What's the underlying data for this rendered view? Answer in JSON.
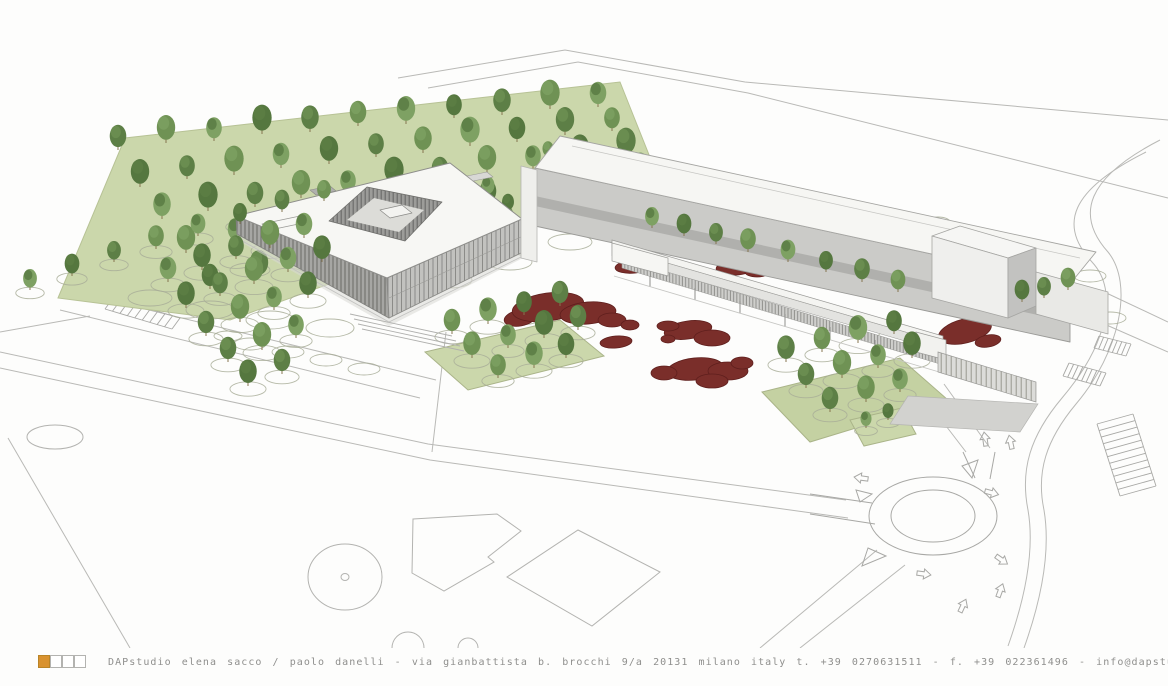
{
  "footer": {
    "studio": "DAPstudio",
    "partners": "elena sacco / paolo danelli",
    "address": "via gianbattista b. brocchi 9/a 20131 milano italy",
    "phone": "t. +39 0270631511",
    "fax": "f. +39 022361496",
    "email": "info@dapstudio.com",
    "website": "www.dapstudio.com",
    "text": "DAPstudio elena sacco / paolo danelli - via gianbattista b. brocchi 9/a 20131 milano italy  t. +39 0270631511 - f. +39 022361496 - info@dapstudio.com - www.dapstudio.com",
    "logo_squares": 4,
    "accent_color": "#d9922f"
  },
  "colors": {
    "accent": "#d9922f",
    "line": "#b6b6b3",
    "line_soft": "#c6c6c3",
    "lawn": "#cbd7ab",
    "lawn_stroke": "#a3ab84",
    "red_bed": "#7a2e2a",
    "red_bed_stroke": "#5f1f1d",
    "roof_white": "#f7f7f4",
    "facade_gray": "#c9c9c6",
    "trunk": "#86754f",
    "circle_outline": "#a8ad98"
  },
  "scene": {
    "description": "aerial rendering of courtyard building, linear building with canopy walkway, tree grove, plaza with red planting beds, parking and roundabout",
    "tree_palette": [
      "#5d7f46",
      "#6f9254",
      "#7ea163",
      "#55773f"
    ],
    "tree_groups": [
      {
        "name": "grove-back",
        "layer": "back",
        "circles": false,
        "trees": [
          [
            118,
            150,
            18
          ],
          [
            166,
            143,
            20
          ],
          [
            214,
            141,
            17
          ],
          [
            262,
            134,
            21
          ],
          [
            310,
            132,
            19
          ],
          [
            358,
            126,
            18
          ],
          [
            406,
            124,
            20
          ],
          [
            454,
            118,
            17
          ],
          [
            502,
            115,
            19
          ],
          [
            550,
            109,
            21
          ],
          [
            598,
            107,
            18
          ],
          [
            140,
            187,
            20
          ],
          [
            187,
            179,
            17
          ],
          [
            234,
            175,
            21
          ],
          [
            281,
            168,
            18
          ],
          [
            329,
            164,
            20
          ],
          [
            376,
            157,
            17
          ],
          [
            423,
            153,
            19
          ],
          [
            470,
            146,
            21
          ],
          [
            517,
            142,
            18
          ],
          [
            565,
            135,
            20
          ],
          [
            612,
            131,
            17
          ],
          [
            162,
            219,
            19
          ],
          [
            208,
            211,
            21
          ],
          [
            255,
            207,
            18
          ],
          [
            301,
            198,
            20
          ],
          [
            348,
            194,
            17
          ],
          [
            394,
            186,
            21
          ],
          [
            440,
            182,
            18
          ],
          [
            487,
            173,
            20
          ],
          [
            533,
            169,
            17
          ],
          [
            580,
            161,
            19
          ],
          [
            626,
            157,
            21
          ],
          [
            186,
            253,
            20
          ],
          [
            236,
            243,
            18
          ],
          [
            287,
            237,
            21
          ],
          [
            337,
            227,
            17
          ],
          [
            388,
            221,
            19
          ],
          [
            438,
            211,
            21
          ],
          [
            488,
            205,
            18
          ],
          [
            539,
            195,
            20
          ],
          [
            589,
            189,
            17
          ],
          [
            640,
            179,
            19
          ],
          [
            210,
            289,
            18
          ],
          [
            259,
            278,
            20
          ],
          [
            308,
            271,
            17
          ],
          [
            357,
            261,
            19
          ],
          [
            406,
            250,
            21
          ],
          [
            455,
            243,
            18
          ],
          [
            504,
            231,
            20
          ],
          [
            553,
            224,
            17
          ],
          [
            602,
            213,
            19
          ],
          [
            652,
            206,
            21
          ]
        ]
      },
      {
        "name": "gap-trees",
        "layer": "back",
        "circles": false,
        "trees": [
          [
            468,
            206,
            13
          ],
          [
            488,
            196,
            14
          ],
          [
            508,
            212,
            13
          ],
          [
            478,
            222,
            12
          ],
          [
            548,
            158,
            12
          ]
        ]
      },
      {
        "name": "facade-row",
        "layer": "mid",
        "circles": true,
        "trees": [
          [
            652,
            228,
            15
          ],
          [
            684,
            236,
            16
          ],
          [
            716,
            244,
            15
          ],
          [
            748,
            252,
            17
          ],
          [
            788,
            262,
            16
          ],
          [
            826,
            272,
            15
          ],
          [
            862,
            282,
            17
          ],
          [
            898,
            292,
            16
          ]
        ]
      },
      {
        "name": "row-left",
        "layer": "front",
        "circles": true,
        "trees": [
          [
            30,
            290,
            15
          ],
          [
            72,
            276,
            16
          ],
          [
            114,
            262,
            15
          ],
          [
            156,
            249,
            17
          ],
          [
            198,
            236,
            16
          ],
          [
            240,
            224,
            15
          ],
          [
            282,
            212,
            16
          ],
          [
            324,
            201,
            15
          ]
        ]
      },
      {
        "name": "cluster-front-left",
        "layer": "front",
        "circles": true,
        "trees": [
          [
            168,
            282,
            18
          ],
          [
            202,
            270,
            19
          ],
          [
            236,
            259,
            17
          ],
          [
            270,
            248,
            20
          ],
          [
            304,
            238,
            18
          ],
          [
            186,
            308,
            19
          ],
          [
            220,
            296,
            17
          ],
          [
            254,
            284,
            20
          ],
          [
            288,
            272,
            18
          ],
          [
            322,
            262,
            19
          ],
          [
            206,
            336,
            18
          ],
          [
            240,
            322,
            20
          ],
          [
            274,
            310,
            17
          ],
          [
            308,
            298,
            19
          ],
          [
            228,
            362,
            18
          ],
          [
            262,
            350,
            20
          ],
          [
            296,
            338,
            17
          ],
          [
            248,
            386,
            19
          ],
          [
            282,
            374,
            18
          ]
        ]
      },
      {
        "name": "plaza-left-cluster",
        "layer": "front",
        "circles": true,
        "trees": [
          [
            452,
            334,
            18
          ],
          [
            488,
            324,
            19
          ],
          [
            524,
            315,
            17
          ],
          [
            560,
            306,
            18
          ],
          [
            472,
            358,
            19
          ],
          [
            508,
            348,
            17
          ],
          [
            544,
            338,
            20
          ],
          [
            578,
            330,
            18
          ],
          [
            498,
            378,
            17
          ],
          [
            534,
            368,
            19
          ],
          [
            566,
            358,
            18
          ]
        ]
      },
      {
        "name": "plaza-right-cluster",
        "layer": "front",
        "circles": true,
        "trees": [
          [
            786,
            362,
            19
          ],
          [
            822,
            352,
            18
          ],
          [
            858,
            343,
            20
          ],
          [
            894,
            334,
            17
          ],
          [
            806,
            388,
            18
          ],
          [
            842,
            378,
            20
          ],
          [
            878,
            368,
            17
          ],
          [
            912,
            358,
            19
          ],
          [
            830,
            412,
            18
          ],
          [
            866,
            402,
            19
          ],
          [
            900,
            392,
            17
          ]
        ]
      },
      {
        "name": "far-right-trees",
        "layer": "front",
        "circles": true,
        "trees": [
          [
            1022,
            302,
            16
          ],
          [
            1044,
            298,
            15
          ],
          [
            1068,
            290,
            16
          ]
        ]
      },
      {
        "name": "roundabout-patch-trees",
        "layer": "front",
        "circles": true,
        "trees": [
          [
            866,
            428,
            12
          ],
          [
            888,
            420,
            12
          ]
        ]
      }
    ],
    "extra_circles": [
      [
        150,
        298,
        22,
        8
      ],
      [
        210,
        310,
        24,
        9
      ],
      [
        270,
        320,
        24,
        9
      ],
      [
        330,
        328,
        24,
        9
      ],
      [
        390,
        300,
        22,
        8
      ],
      [
        450,
        280,
        22,
        8
      ],
      [
        510,
        262,
        22,
        8
      ],
      [
        570,
        242,
        22,
        8
      ],
      [
        620,
        220,
        20,
        7
      ],
      [
        250,
        270,
        20,
        7
      ],
      [
        310,
        250,
        20,
        7
      ],
      [
        370,
        232,
        20,
        7
      ],
      [
        968,
        243,
        20,
        8
      ],
      [
        1002,
        252,
        20,
        8
      ],
      [
        1036,
        264,
        22,
        9
      ],
      [
        986,
        268,
        18,
        7
      ],
      [
        1020,
        278,
        20,
        8
      ],
      [
        1054,
        292,
        22,
        9
      ],
      [
        1090,
        276,
        16,
        6
      ],
      [
        952,
        233,
        14,
        6
      ],
      [
        938,
        222,
        12,
        5
      ],
      [
        962,
        230,
        12,
        5
      ],
      [
        1082,
        306,
        18,
        7
      ],
      [
        1110,
        318,
        16,
        6
      ],
      [
        250,
        344,
        16,
        6
      ],
      [
        288,
        352,
        16,
        6
      ],
      [
        326,
        360,
        16,
        6
      ],
      [
        364,
        369,
        16,
        6
      ],
      [
        228,
        336,
        14,
        5
      ]
    ],
    "red_beds": [
      [
        520,
        318,
        16,
        8,
        -10
      ],
      [
        548,
        307,
        36,
        14,
        -8
      ],
      [
        588,
        313,
        28,
        11,
        -5
      ],
      [
        612,
        320,
        14,
        7,
        0
      ],
      [
        630,
        325,
        9,
        5,
        0
      ],
      [
        616,
        342,
        16,
        6,
        -5
      ],
      [
        688,
        330,
        24,
        9,
        -8
      ],
      [
        712,
        338,
        18,
        8,
        0
      ],
      [
        668,
        326,
        11,
        5,
        0
      ],
      [
        668,
        339,
        7,
        4,
        0
      ],
      [
        695,
        369,
        28,
        11,
        -6
      ],
      [
        728,
        371,
        20,
        9,
        0
      ],
      [
        664,
        373,
        13,
        7,
        0
      ],
      [
        742,
        363,
        11,
        6,
        0
      ],
      [
        712,
        381,
        16,
        7,
        0
      ],
      [
        635,
        266,
        20,
        7,
        -6
      ],
      [
        737,
        267,
        21,
        8,
        -6
      ],
      [
        757,
        272,
        12,
        5,
        0
      ],
      [
        965,
        331,
        27,
        12,
        -14
      ],
      [
        988,
        341,
        13,
        6,
        -10
      ]
    ],
    "arrows": [
      [
        868,
        479,
        188
      ],
      [
        986,
        446,
        262
      ],
      [
        1012,
        449,
        258
      ],
      [
        985,
        491,
        15
      ],
      [
        996,
        556,
        35
      ],
      [
        917,
        573,
        8
      ],
      [
        960,
        612,
        -65
      ],
      [
        998,
        597,
        -70
      ]
    ],
    "hatch_bands": [
      {
        "name": "zebra-left",
        "x1": 105,
        "y1": 309,
        "x2": 172,
        "y2": 329,
        "dx": 8,
        "dy": -11,
        "n": 9
      },
      {
        "name": "stalls-ne-roundabout",
        "x1": 1097,
        "y1": 424,
        "x2": 1120,
        "y2": 496,
        "dx": 36,
        "dy": -10,
        "n": 11
      },
      {
        "name": "stalls-right-1",
        "x1": 1063,
        "y1": 376,
        "x2": 1100,
        "y2": 386,
        "dx": 6,
        "dy": -13,
        "n": 8
      },
      {
        "name": "stalls-right-2",
        "x1": 1094,
        "y1": 348,
        "x2": 1126,
        "y2": 356,
        "dx": 5,
        "dy": -12,
        "n": 7
      }
    ]
  }
}
